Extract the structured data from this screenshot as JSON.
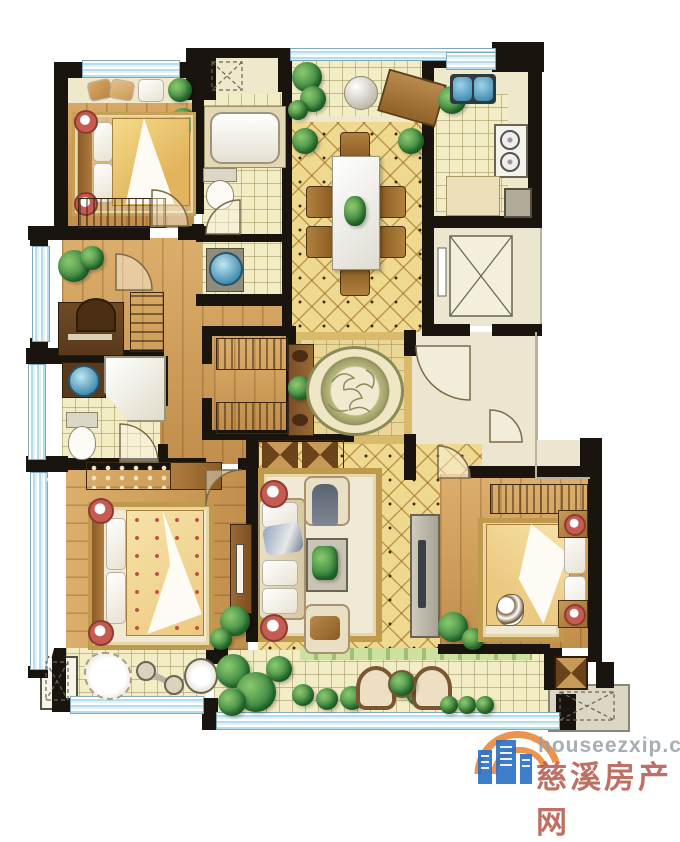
{
  "image_type": "residential-floor-plan-rendering",
  "watermark": {
    "site": "houseezxip.com",
    "brand": "慈溪房产网",
    "logo": "building-icon-with-orange-arcs"
  },
  "palette": {
    "wall": "#1a140e",
    "wood_floor": "#cf9c55",
    "tile_warm": "#eed98f",
    "tile_pale": "#f3edc6",
    "window_glass": "#b9dcea",
    "landing": "#ece6d1",
    "plant_green": "#2e7d3a",
    "accent_red": "#c65b52",
    "rug_border": "#bf9a4c",
    "watermark_blue": "#2a6fc4",
    "watermark_orange": "#e8781e",
    "watermark_gray": "#979fa8"
  },
  "rooms": [
    {
      "id": "bedroom-top-left",
      "fixtures": [
        "double-bed",
        "bedside-rug",
        "window-seat-pillows",
        "wardrobe",
        "plant"
      ]
    },
    {
      "id": "bathroom-main",
      "fixtures": [
        "bathtub",
        "toilet",
        "vent-shaft"
      ]
    },
    {
      "id": "powder-room",
      "fixtures": [
        "washbasin"
      ]
    },
    {
      "id": "top-balcony",
      "fixtures": [
        "lounge-chair",
        "ball-table",
        "plants"
      ]
    },
    {
      "id": "dining-room",
      "fixtures": [
        "dining-table",
        "six-chairs",
        "entry-plants"
      ]
    },
    {
      "id": "kitchen",
      "fixtures": [
        "double-sink",
        "gas-stove",
        "island-counter",
        "appliance"
      ]
    },
    {
      "id": "elevator",
      "fixtures": [
        "elevator-car"
      ]
    },
    {
      "id": "stair-landing",
      "fixtures": [
        "entry-door",
        "neighbor-door"
      ]
    },
    {
      "id": "study",
      "fixtures": [
        "desk",
        "chair",
        "bookshelf",
        "plant"
      ]
    },
    {
      "id": "bathroom-second",
      "fixtures": [
        "corner-bathtub",
        "washbasin",
        "toilet"
      ]
    },
    {
      "id": "hallway-foyer",
      "fixtures": [
        "closet-wardrobes",
        "console-table",
        "medallion-floor"
      ]
    },
    {
      "id": "living-room",
      "fixtures": [
        "sofa",
        "armchair-top",
        "armchair-bottom",
        "coffee-table",
        "side-tables",
        "tv-cabinet",
        "area-rug",
        "people"
      ]
    },
    {
      "id": "master-bedroom",
      "fixtures": [
        "double-bed",
        "wardrobe",
        "tv-cabinet",
        "area-rug",
        "plants",
        "bay-window"
      ]
    },
    {
      "id": "bedroom-right",
      "fixtures": [
        "double-bed",
        "wardrobe",
        "nightstands",
        "dog",
        "plant"
      ]
    },
    {
      "id": "gym-alcove",
      "fixtures": [
        "fluffy-rug",
        "dumbbell",
        "stool"
      ]
    },
    {
      "id": "lower-balcony",
      "fixtures": [
        "wicker-chair",
        "wicker-chair",
        "tea-table",
        "planters",
        "shrubs"
      ]
    },
    {
      "id": "ac-platform",
      "fixtures": [
        "condenser-pad"
      ]
    },
    {
      "id": "utility-shaft",
      "fixtures": []
    }
  ]
}
